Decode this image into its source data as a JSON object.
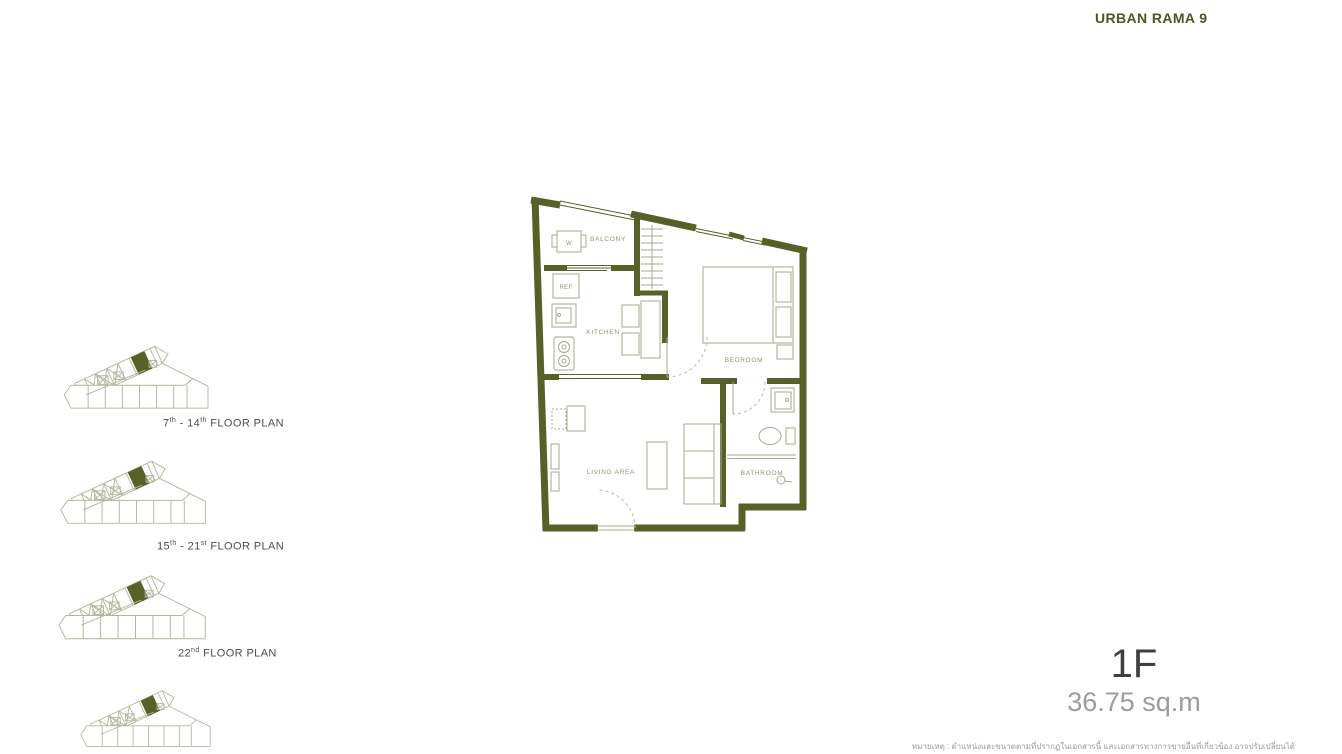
{
  "header": {
    "title": "URBAN RAMA 9"
  },
  "floor_selector": {
    "floors": [
      {
        "a": "7",
        "sup_a": "th",
        "b": " - 14",
        "sup_b": "th",
        "suffix": " FLOOR PLAN"
      },
      {
        "a": "15",
        "sup_a": "th",
        "b": " - 21",
        "sup_b": "st",
        "suffix": " FLOOR PLAN"
      },
      {
        "a": "22",
        "sup_a": "nd",
        "b": "",
        "sup_b": "",
        "suffix": " FLOOR PLAN"
      }
    ]
  },
  "unit_plan": {
    "room_labels": {
      "balcony": "BALCONY",
      "kitchen": "KITCHEN",
      "bedroom": "BEDROOM",
      "living_area": "LIVING AREA",
      "bathroom": "BATHROOM"
    },
    "fixture_labels": {
      "washer": "W",
      "refrigerator": "REF"
    },
    "colors": {
      "wall": "#566128",
      "furniture_line": "#a6ab8c"
    }
  },
  "unit_info": {
    "unit_type": "1F",
    "unit_area": "36.75 sq.m"
  },
  "footnote": "หมายเหตุ : ตำแหน่งและขนาดตามที่ปรากฏในเอกสารนี้ และเอกสารทางการขายอื่นที่เกี่ยวข้อง อาจปรับเปลี่ยนได้"
}
